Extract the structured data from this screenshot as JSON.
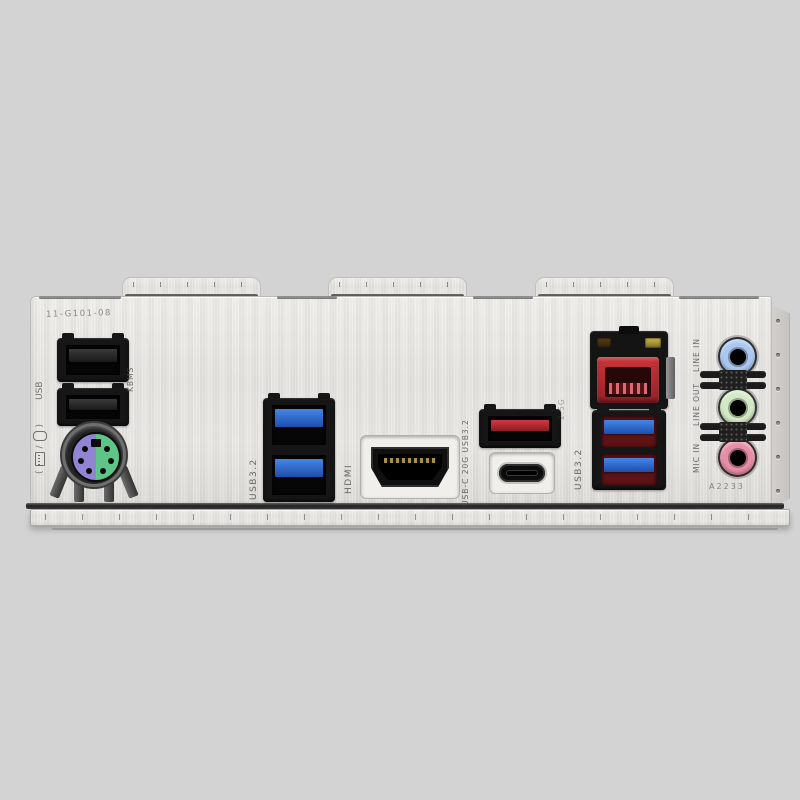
{
  "scene": {
    "description": "Photograph of a motherboard rear I/O panel (brushed-aluminum integrated I/O shield) on a plain gray background",
    "background_color": "#d3d3d3",
    "plate_color": "#e8e6e3"
  },
  "prints": {
    "part_number": "11-G101-08",
    "kbms_label": "KBMS",
    "left_label": {
      "paren_open": "(",
      "slash": "/",
      "paren_close": ")",
      "usb": "USB"
    },
    "usb32_blue_label": "USB3.2",
    "hdmi_label": "HDMI",
    "usbc_label": "USB-C 20G USB3.2",
    "usb32_red_label": "USB3.2",
    "lan_print": "2.5G",
    "audio_labels": {
      "line_in": "LINE IN",
      "line_out": "LINE OUT",
      "mic_in": "MIC IN"
    },
    "bottom_code": "A2233"
  },
  "ports": [
    {
      "name": "usb2-a",
      "type": "USB 2.0 Type-A",
      "count": 2,
      "housing_color": "#161616"
    },
    {
      "name": "ps2-combo",
      "type": "PS/2 keyboard/mouse combo",
      "keyboard_color": "#8f80d2",
      "mouse_color": "#5ec487"
    },
    {
      "name": "usb32-blue",
      "type": "USB 3.2 Type-A",
      "count": 2,
      "tongue_color": "#2a67cf"
    },
    {
      "name": "hdmi",
      "type": "HDMI"
    },
    {
      "name": "usb-a-red",
      "type": "USB 3.2 Type-A (red)",
      "count": 1,
      "tongue_color": "#c1272d"
    },
    {
      "name": "usb-c",
      "type": "USB Type-C 20Gbps",
      "count": 1
    },
    {
      "name": "lan-rj45",
      "type": "2.5G Ethernet RJ-45",
      "count": 1,
      "jack_color": "#b42a30"
    },
    {
      "name": "usb32-red-pair",
      "type": "USB 3.2 Type-A (red housing, blue tongue)",
      "count": 2
    },
    {
      "name": "audio-jacks",
      "type": "3.5 mm audio",
      "jacks": [
        "line-in",
        "line-out",
        "mic-in"
      ],
      "colors": [
        "#a9c7f0",
        "#d3e9c5",
        "#e78da6"
      ]
    }
  ]
}
